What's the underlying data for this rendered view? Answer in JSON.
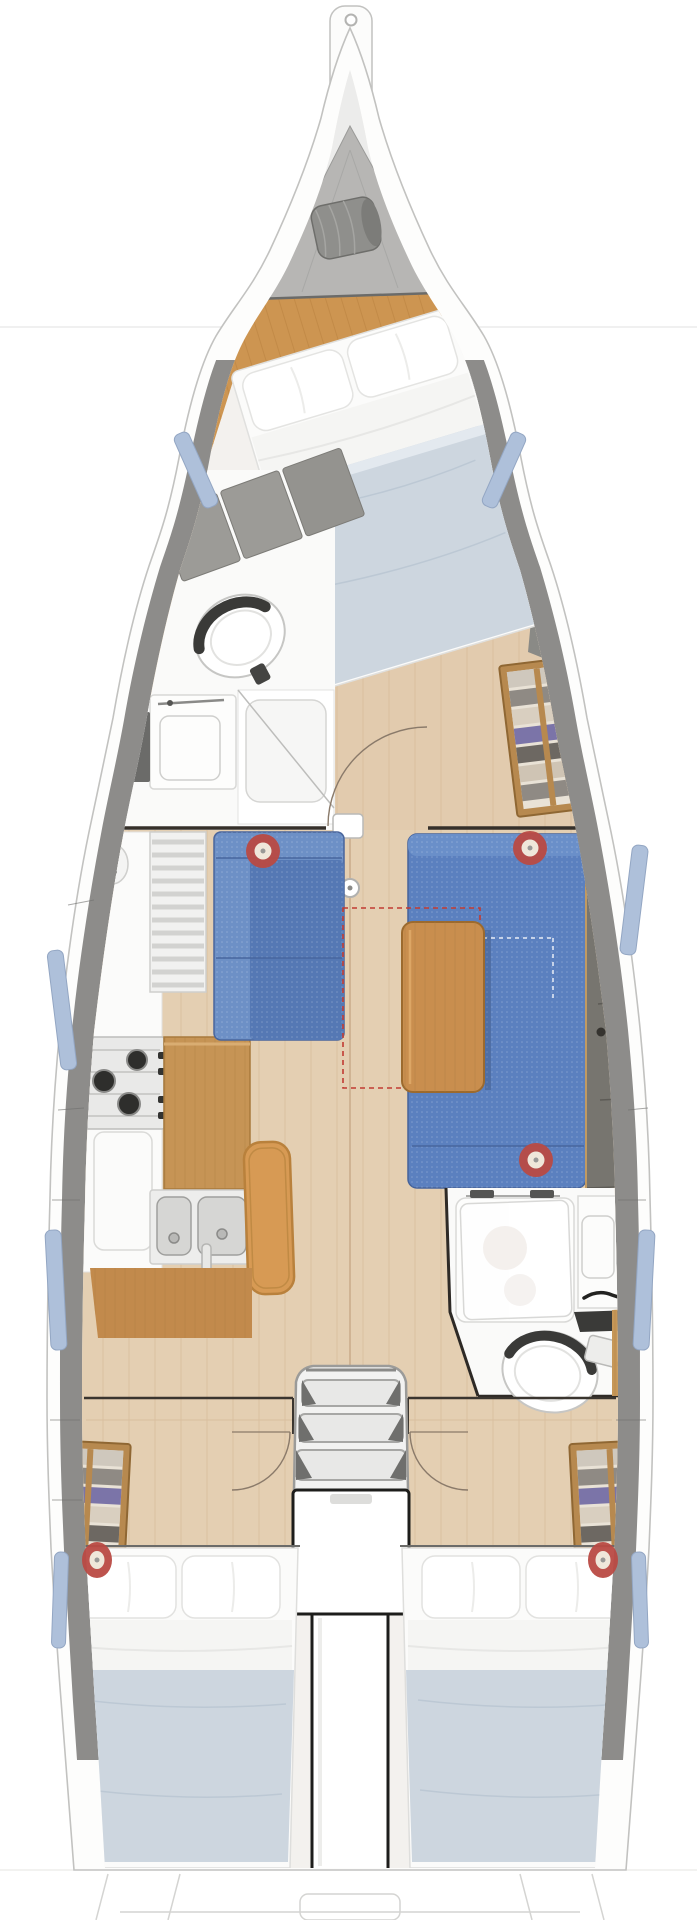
{
  "meta": {
    "title": "sailboat-interior-floor-plan-overhead",
    "orientation": "bow-up",
    "visible_text": ""
  },
  "palette": {
    "page_bg": "#ffffff",
    "hull_fill": "#fdfdfc",
    "hull_outline": "#c2c2c0",
    "deck_band": "#8d8c8a",
    "deck_band_edge": "#6f6f6d",
    "window_blue": "#aec0da",
    "window_edge": "#93a6c3",
    "bow_bilge": "#ececeb",
    "locker_gray": "#b7b6b4",
    "sailbag_gray": "#8f8f8c",
    "wood_forward": "#cd9551",
    "wood_floor": "#e4cfb2",
    "wood_plank_line": "#d2b592",
    "wood_counter": "#c69455",
    "wood_table": "#c98e4e",
    "wood_shelf_frame": "#b7894f",
    "bench_orange": "#d79a54",
    "settee_blue": "#5b80bf",
    "settee_blue_light": "#6d90c6",
    "settee_blue_deep": "#5578b4",
    "settee_seam": "#47659e",
    "back_cushion_gray": "#77756f",
    "upholstery_gray": "#9c9b97",
    "duvet_blue": "#cdd6df",
    "duvet_fold": "#bcc8d4",
    "mattress_white": "#fbfbfa",
    "sheet_white": "#f5f5f3",
    "fixture_white": "#fdfdfc",
    "fixture_edge": "#d8d8d6",
    "steel_gray": "#d6d6d4",
    "steel_dark": "#9f9f9d",
    "burner_black": "#2e2e2c",
    "marker_red": "#b94a43",
    "marker_center": "#efe7da",
    "bulkhead_dark": "#35302a",
    "engine_outline": "#1d1d1b",
    "arc_line": "#8a7a6a",
    "dashed_red": "#c23b32",
    "faint_line": "#ebebeb"
  },
  "inventory": {
    "cabins": 3,
    "heads": 2,
    "double_berths": 3,
    "pillows_per_aft_berth": 2,
    "stove_burners": 3,
    "sink_bowls": 2,
    "companionway_steps": 3,
    "red_marker_rings": 5,
    "hull_windows_per_side": 4,
    "storage_shelf_units": 3
  }
}
